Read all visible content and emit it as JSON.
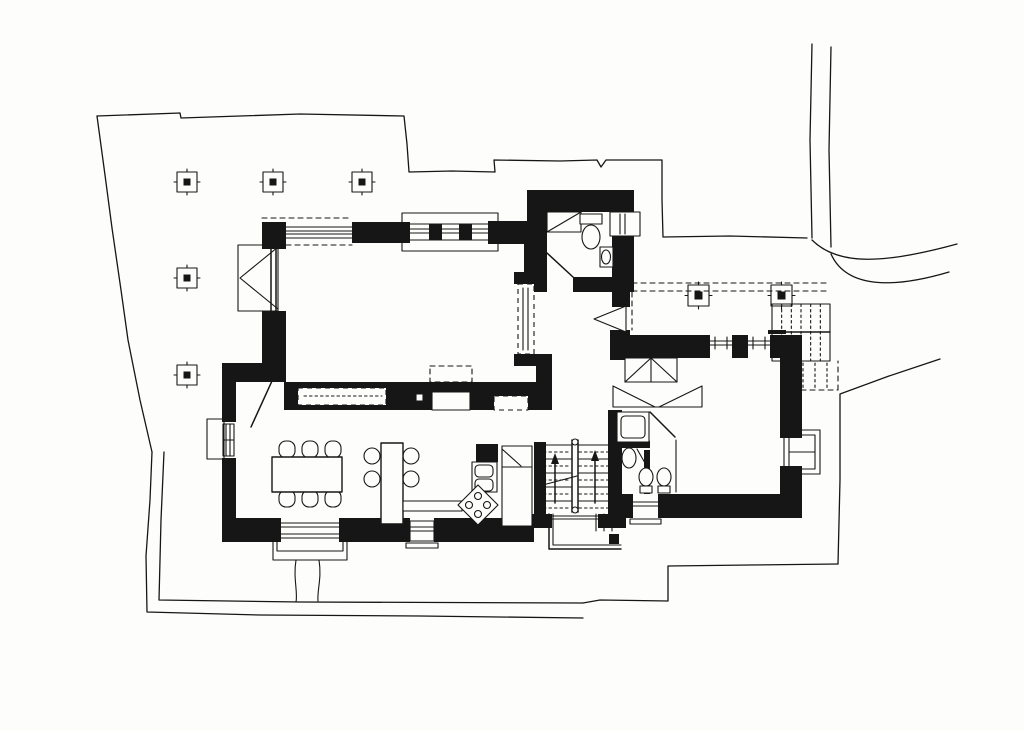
{
  "meta": {
    "drawing_kind": "hand-drawn villa ground-floor plan, black ink on white paper",
    "colors": {
      "ink": "#161616",
      "paper": "#fdfdfb"
    }
  },
  "inventory": {
    "rooms": [
      "west-terrace",
      "living-room",
      "dining-room",
      "kitchen",
      "entry-hall",
      "wc",
      "staircase",
      "bathroom",
      "bedroom",
      "east-terrace"
    ],
    "fixtures": {
      "terrace_columns_west": 5,
      "terrace_columns_east": 2,
      "dining_chairs": 6,
      "bar_stools": 4,
      "stove_burners": 4,
      "wc_fixtures": [
        "toilet",
        "washbasin",
        "window",
        "closet"
      ],
      "bathroom_fixtures": [
        "bathtub",
        "washbasin",
        "toilet",
        "bidet"
      ],
      "other": [
        "fireplace",
        "built-in-bench",
        "wardrobe",
        "bay-window-planter",
        "exterior-steps",
        "garden-landing"
      ]
    }
  },
  "render": {
    "west_columns": [
      {
        "x": 177,
        "y": 172,
        "size": 20,
        "core": 7
      },
      {
        "x": 263,
        "y": 172,
        "size": 20,
        "core": 7
      },
      {
        "x": 352,
        "y": 172,
        "size": 20,
        "core": 7
      },
      {
        "x": 177,
        "y": 268,
        "size": 20,
        "core": 7
      },
      {
        "x": 177,
        "y": 365,
        "size": 20,
        "core": 7
      }
    ],
    "east_columns": [
      {
        "x": 688,
        "y": 285,
        "size": 21,
        "core": 8
      },
      {
        "x": 771,
        "y": 285,
        "size": 21,
        "core": 8
      }
    ],
    "east_steps": {
      "x": 772,
      "y": 304,
      "width": 58,
      "height": 57,
      "risers": 5,
      "rail_y": 332
    },
    "stairs": {
      "flights": [
        {
          "x1": 538,
          "x2": 571
        },
        {
          "x1": 579,
          "x2": 612
        }
      ],
      "tread_y_start": 445,
      "tread_step": 7,
      "tread_count": 10,
      "stringer": {
        "x1": 572,
        "x2": 578,
        "y1": 440,
        "y2": 512
      },
      "arrows": [
        {
          "x": 555,
          "y_tail": 503,
          "y_head": 453
        },
        {
          "x": 595,
          "y_tail": 503,
          "y_head": 450
        }
      ]
    }
  }
}
